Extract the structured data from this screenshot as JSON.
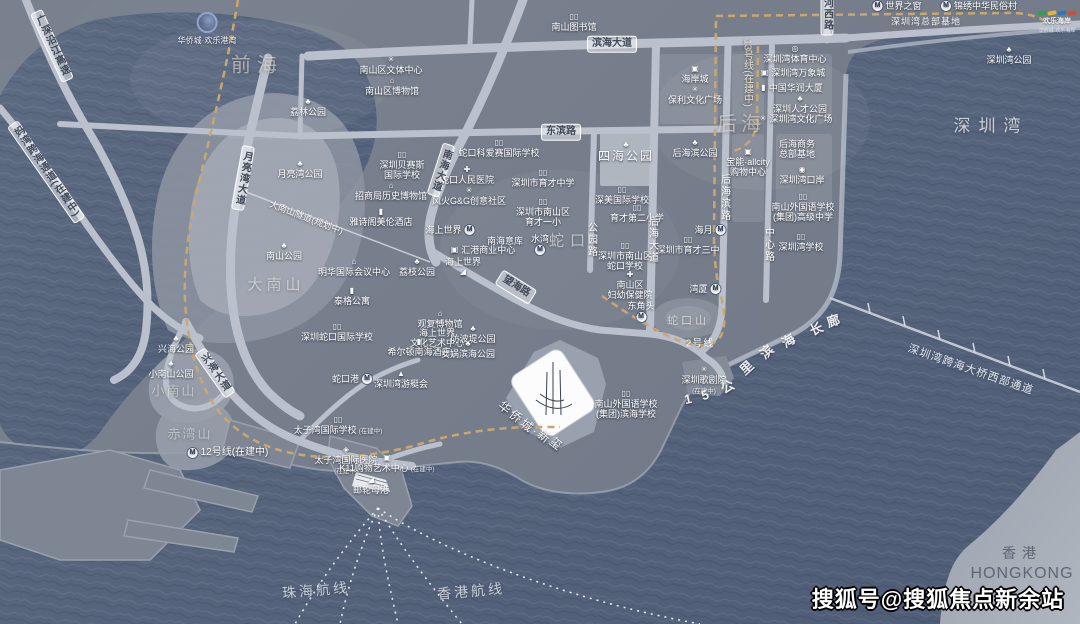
{
  "watermark": "搜狐号@搜狐焦点新余站",
  "hk": {
    "cn": "香港",
    "en": "HONGKONG"
  },
  "logos": {
    "gangwan": "华侨城·欢乐港湾",
    "haian_title": "欢乐海岸",
    "haian_sub": "华侨城·欢乐海岸",
    "haian_wave_colors": [
      "#2e9e4f",
      "#e3b63a",
      "#2d76c0",
      "#cf4f35"
    ]
  },
  "colors": {
    "water": "#55637b",
    "land": "#79818e",
    "road": "#bac1cc",
    "metro_line": "#c9a76e",
    "hill": "#919aa7",
    "parcel": "#fcfcfd"
  },
  "iconGlyphs": {
    "tree": "♣",
    "museum": "⌂",
    "school": "▯▯",
    "book": "▯▯",
    "hospital": "✚",
    "gear": "✳",
    "culture": "✳",
    "mall": "▣",
    "stadium": "◎",
    "tower": "▮",
    "ship": "◢",
    "yacht": "▲",
    "port": "◉",
    "mail": "▤",
    "diamond": "◈"
  },
  "pois": [
    {
      "x": 574,
      "y": 13,
      "icon": "book",
      "t": "南山图书馆"
    },
    {
      "x": 391,
      "y": 56,
      "icon": "culture",
      "t": "南山区文体中心"
    },
    {
      "x": 392,
      "y": 77,
      "icon": "museum",
      "t": "南山区博物馆"
    },
    {
      "x": 499,
      "y": 139,
      "icon": "school",
      "t": "蛇口科爱赛国际学校"
    },
    {
      "x": 402,
      "y": 151,
      "icon": "school",
      "t": "深圳贝赛斯",
      "t2": "国际学校"
    },
    {
      "x": 391,
      "y": 182,
      "icon": "museum",
      "t": "招商局历史博物馆"
    },
    {
      "x": 467,
      "y": 166,
      "icon": "hospital",
      "t": "蛇口人民医院"
    },
    {
      "x": 469,
      "y": 187,
      "icon": "gear",
      "t": "风火G&G创意社区"
    },
    {
      "x": 543,
      "y": 169,
      "icon": "school",
      "t": "深圳市育才中学"
    },
    {
      "x": 543,
      "y": 198,
      "icon": "school",
      "t": "深圳市南山区",
      "t2": "育才一小"
    },
    {
      "x": 626,
      "y": 141,
      "icon": "tree",
      "t": "四海公园",
      "big": true
    },
    {
      "x": 622,
      "y": 186,
      "icon": "school",
      "t": "深美国际学校"
    },
    {
      "x": 637,
      "y": 204,
      "icon": "school",
      "t": "育才第二小学"
    },
    {
      "x": 695,
      "y": 139,
      "icon": "tree",
      "t": "后海滨公园"
    },
    {
      "x": 695,
      "y": 65,
      "icon": "mall",
      "t": "海岸城"
    },
    {
      "x": 695,
      "y": 86,
      "icon": "gear",
      "t": "保利文化广场"
    },
    {
      "x": 795,
      "y": 45,
      "icon": "stadium",
      "t": "深圳湾体育中心"
    },
    {
      "x": 793,
      "y": 68,
      "icon": "mall",
      "t": "深圳湾万象城",
      "ipos": "left"
    },
    {
      "x": 792,
      "y": 83,
      "icon": "tower",
      "t": "中国华润大厦",
      "ipos": "left"
    },
    {
      "x": 800,
      "y": 95,
      "icon": "tree",
      "t": "深圳人才公园"
    },
    {
      "x": 796,
      "y": 114,
      "icon": "gear",
      "t": "深圳湾文化广场",
      "ipos": "left"
    },
    {
      "x": 1009,
      "y": 46,
      "icon": "tree",
      "t": "深圳湾公园"
    },
    {
      "x": 897,
      "y": 1,
      "icon": "metro",
      "t": "世界之窗",
      "ipos": "left"
    },
    {
      "x": 979,
      "y": 1,
      "icon": "metro",
      "t": "锦绣中华民俗村",
      "ipos": "left"
    },
    {
      "x": 748,
      "y": 148,
      "icon": "mall",
      "t": "宝能·allcity",
      "t2": "购物中心"
    },
    {
      "x": 797,
      "y": 139,
      "t": "后海商务",
      "t2": "总部基地"
    },
    {
      "x": 802,
      "y": 166,
      "icon": "port",
      "t": "深圳湾口岸"
    },
    {
      "x": 803,
      "y": 193,
      "icon": "school",
      "t": "南山外国语学校",
      "t2": "(集团)高级中学"
    },
    {
      "x": 801,
      "y": 233,
      "icon": "school",
      "t": "深圳湾学校"
    },
    {
      "x": 688,
      "y": 236,
      "icon": "school",
      "t": "深圳市育才三中"
    },
    {
      "x": 710,
      "y": 225,
      "icon": "metro",
      "t": "海月",
      "ipos": "right"
    },
    {
      "x": 705,
      "y": 284,
      "icon": "metro",
      "t": "湾厦",
      "ipos": "right"
    },
    {
      "x": 641,
      "y": 301,
      "icon": "metro",
      "t": "东角头",
      "ipos": "below"
    },
    {
      "x": 540,
      "y": 234,
      "icon": "metro",
      "t": "水湾",
      "ipos": "below"
    },
    {
      "x": 450,
      "y": 225,
      "icon": "metro",
      "t": "海上世界",
      "ipos": "right"
    },
    {
      "x": 505,
      "y": 236,
      "t": "南海意库"
    },
    {
      "x": 483,
      "y": 245,
      "icon": "mall",
      "t": "汇港商业中心",
      "ipos": "left"
    },
    {
      "x": 463,
      "y": 257,
      "icon": "ship",
      "t": "海上世界",
      "ipos": "below"
    },
    {
      "x": 625,
      "y": 242,
      "icon": "school",
      "t": "深圳市南山区",
      "t2": "蛇口学校"
    },
    {
      "x": 630,
      "y": 271,
      "icon": "hospital",
      "t": "南山区",
      "t2": "妇幼保健院"
    },
    {
      "x": 417,
      "y": 258,
      "icon": "tree",
      "t": "荔枝公园"
    },
    {
      "x": 440,
      "y": 310,
      "icon": "museum",
      "t": "观复博物馆"
    },
    {
      "x": 437,
      "y": 319,
      "icon": "gear",
      "t": "海上世界",
      "t2": "文化艺术中心"
    },
    {
      "x": 419,
      "y": 338,
      "icon": "tower",
      "t": "希尔顿南海酒店"
    },
    {
      "x": 473,
      "y": 325,
      "icon": "tree",
      "t": "防波堤公园"
    },
    {
      "x": 468,
      "y": 340,
      "icon": "tree",
      "t": "女娲滨海公园"
    },
    {
      "x": 352,
      "y": 287,
      "icon": "tower",
      "t": "泰格公寓"
    },
    {
      "x": 354,
      "y": 258,
      "icon": "museum",
      "t": "明华国际会议中心"
    },
    {
      "x": 381,
      "y": 208,
      "icon": "tower",
      "t": "雅诗阁美伦酒店"
    },
    {
      "x": 308,
      "y": 98,
      "icon": "tree",
      "t": "荔林公园"
    },
    {
      "x": 300,
      "y": 160,
      "icon": "tree",
      "t": "月亮湾公园"
    },
    {
      "x": 284,
      "y": 242,
      "icon": "tree",
      "t": "南山公园"
    },
    {
      "x": 176,
      "y": 335,
      "icon": "tree",
      "t": "兴海公园"
    },
    {
      "x": 171,
      "y": 360,
      "icon": "tree",
      "t": "小南山公园"
    },
    {
      "x": 337,
      "y": 323,
      "icon": "school",
      "t": "深圳蛇口国际学校"
    },
    {
      "x": 352,
      "y": 374,
      "icon": "metro",
      "t": "蛇口港",
      "ipos": "right"
    },
    {
      "x": 401,
      "y": 370,
      "icon": "yacht",
      "t": "深圳湾游艇会"
    },
    {
      "x": 338,
      "y": 416,
      "icon": "school",
      "t": "太子湾国际学校",
      "sub": "(在建中)"
    },
    {
      "x": 346,
      "y": 446,
      "icon": "diamond",
      "t": "太子湾国际医院",
      "note": "(在建中)"
    },
    {
      "x": 387,
      "y": 454,
      "icon": "mall",
      "t": "K11购物艺术中心",
      "sub": "(在建中)"
    },
    {
      "x": 371,
      "y": 476,
      "icon": "ship",
      "t": "邮轮母港"
    },
    {
      "x": 704,
      "y": 366,
      "icon": "gear",
      "t": "深圳歌剧院",
      "note": "(在建中)"
    },
    {
      "x": 626,
      "y": 390,
      "icon": "school",
      "t": "南山外国语学校",
      "t2": "(集团)滨海学校"
    },
    {
      "x": 228,
      "y": 447,
      "icon": "metro",
      "t": "12号线(在建中)",
      "ipos": "left",
      "cls": "mline"
    }
  ],
  "roadPills": [
    {
      "t": "滨海大道",
      "x": 612,
      "y": 44
    },
    {
      "t": "东滨路",
      "x": 561,
      "y": 132
    },
    {
      "t": "望海路",
      "x": 516,
      "y": 287,
      "rot": 32
    },
    {
      "t": "南海大道",
      "x": 441,
      "y": 170,
      "v": true,
      "rot": 18
    },
    {
      "t": "月亮湾大道",
      "x": 243,
      "y": 178,
      "v": true,
      "rot": 10
    },
    {
      "t": "兴海大道",
      "x": 215,
      "y": 373,
      "v": true,
      "rot": -35
    },
    {
      "t": "河西路",
      "x": 827,
      "y": 14,
      "v": true
    },
    {
      "t": "广深沿江高速",
      "x": 52,
      "y": 46,
      "v": true,
      "rot": -25
    },
    {
      "t": "妈湾跨海通道(在建中)",
      "x": 46,
      "y": 172,
      "v": true,
      "rot": -35
    },
    {
      "t": "大南山隧道(规划中)",
      "x": 306,
      "y": 218,
      "rot": 21,
      "nopill": true
    }
  ],
  "streets": [
    {
      "t": "公园路",
      "x": 591,
      "y": 240
    },
    {
      "t": "后海大道",
      "x": 652,
      "y": 240
    },
    {
      "t": "后海滨路",
      "x": 724,
      "y": 198
    },
    {
      "t": "中心路",
      "x": 768,
      "y": 245
    },
    {
      "t": "13号线(在建中)",
      "x": 747,
      "y": 73,
      "cls": "m13"
    }
  ],
  "bigLabels": [
    {
      "t": "前海",
      "x": 257,
      "y": 63,
      "s": 20,
      "ls": 6,
      "c": "rgba(228,222,208,0.62)"
    },
    {
      "t": "后海",
      "x": 741,
      "y": 122,
      "s": 20,
      "ls": 4,
      "c": "rgba(228,222,208,0.62)"
    },
    {
      "t": "深圳湾",
      "x": 991,
      "y": 124,
      "s": 17,
      "ls": 8,
      "c": "rgba(255,255,255,0.7)"
    },
    {
      "t": "大南山",
      "x": 276,
      "y": 284,
      "s": 15,
      "ls": 4,
      "c": "rgba(255,255,255,0.5)"
    },
    {
      "t": "小南山",
      "x": 174,
      "y": 390,
      "s": 13,
      "ls": 2,
      "c": "rgba(255,255,255,0.45)"
    },
    {
      "t": "赤湾山",
      "x": 190,
      "y": 433,
      "s": 13,
      "ls": 2,
      "c": "rgba(255,255,255,0.45)"
    },
    {
      "t": "蛇口",
      "x": 570,
      "y": 240,
      "s": 15,
      "ls": 6,
      "c": "rgba(255,255,255,0.55)"
    },
    {
      "t": "蛇口山",
      "x": 688,
      "y": 320,
      "s": 11,
      "ls": 3,
      "c": "rgba(255,255,255,0.6)"
    },
    {
      "t": "深圳湾总部基地",
      "x": 926,
      "y": 21,
      "s": 9,
      "ls": 1,
      "c": "rgba(255,255,255,0.9)"
    },
    {
      "t": "2号线",
      "x": 700,
      "y": 342,
      "s": 10,
      "ls": 1,
      "c": "rgba(255,255,255,0.9)"
    },
    {
      "t": "珠海航线",
      "x": 316,
      "y": 590,
      "s": 14,
      "ls": 3,
      "rot": -5,
      "c": "rgba(235,240,246,0.78)"
    },
    {
      "t": "香港航线",
      "x": 471,
      "y": 591,
      "s": 14,
      "ls": 3,
      "rot": -5,
      "c": "rgba(235,240,246,0.78)"
    },
    {
      "t": "深圳湾跨海大桥西部通道",
      "x": 971,
      "y": 369,
      "s": 11,
      "ls": 1,
      "rot": 19,
      "c": "rgba(240,244,250,0.92)"
    }
  ],
  "promenade": [
    {
      "c": "1",
      "x": 688,
      "y": 399,
      "r": -12
    },
    {
      "c": "5",
      "x": 705,
      "y": 395,
      "r": -18
    },
    {
      "c": "公",
      "x": 727,
      "y": 386,
      "r": -30
    },
    {
      "c": "里",
      "x": 746,
      "y": 367,
      "r": -42
    },
    {
      "c": "滨",
      "x": 766,
      "y": 351,
      "r": -42
    },
    {
      "c": "海",
      "x": 788,
      "y": 340,
      "r": -32
    },
    {
      "c": "长",
      "x": 816,
      "y": 328,
      "r": -24
    },
    {
      "c": "廊",
      "x": 833,
      "y": 320,
      "r": -18
    }
  ],
  "property": {
    "chars": [
      {
        "c": "华",
        "x": 505,
        "y": 407,
        "r": 38
      },
      {
        "c": "侨",
        "x": 516,
        "y": 416,
        "r": 38
      },
      {
        "c": "城",
        "x": 527,
        "y": 425,
        "r": 38
      },
      {
        "c": "·",
        "x": 535,
        "y": 431,
        "r": 38
      },
      {
        "c": "新",
        "x": 544,
        "y": 436,
        "r": 38
      },
      {
        "c": "玺",
        "x": 556,
        "y": 443,
        "r": 38
      }
    ]
  }
}
